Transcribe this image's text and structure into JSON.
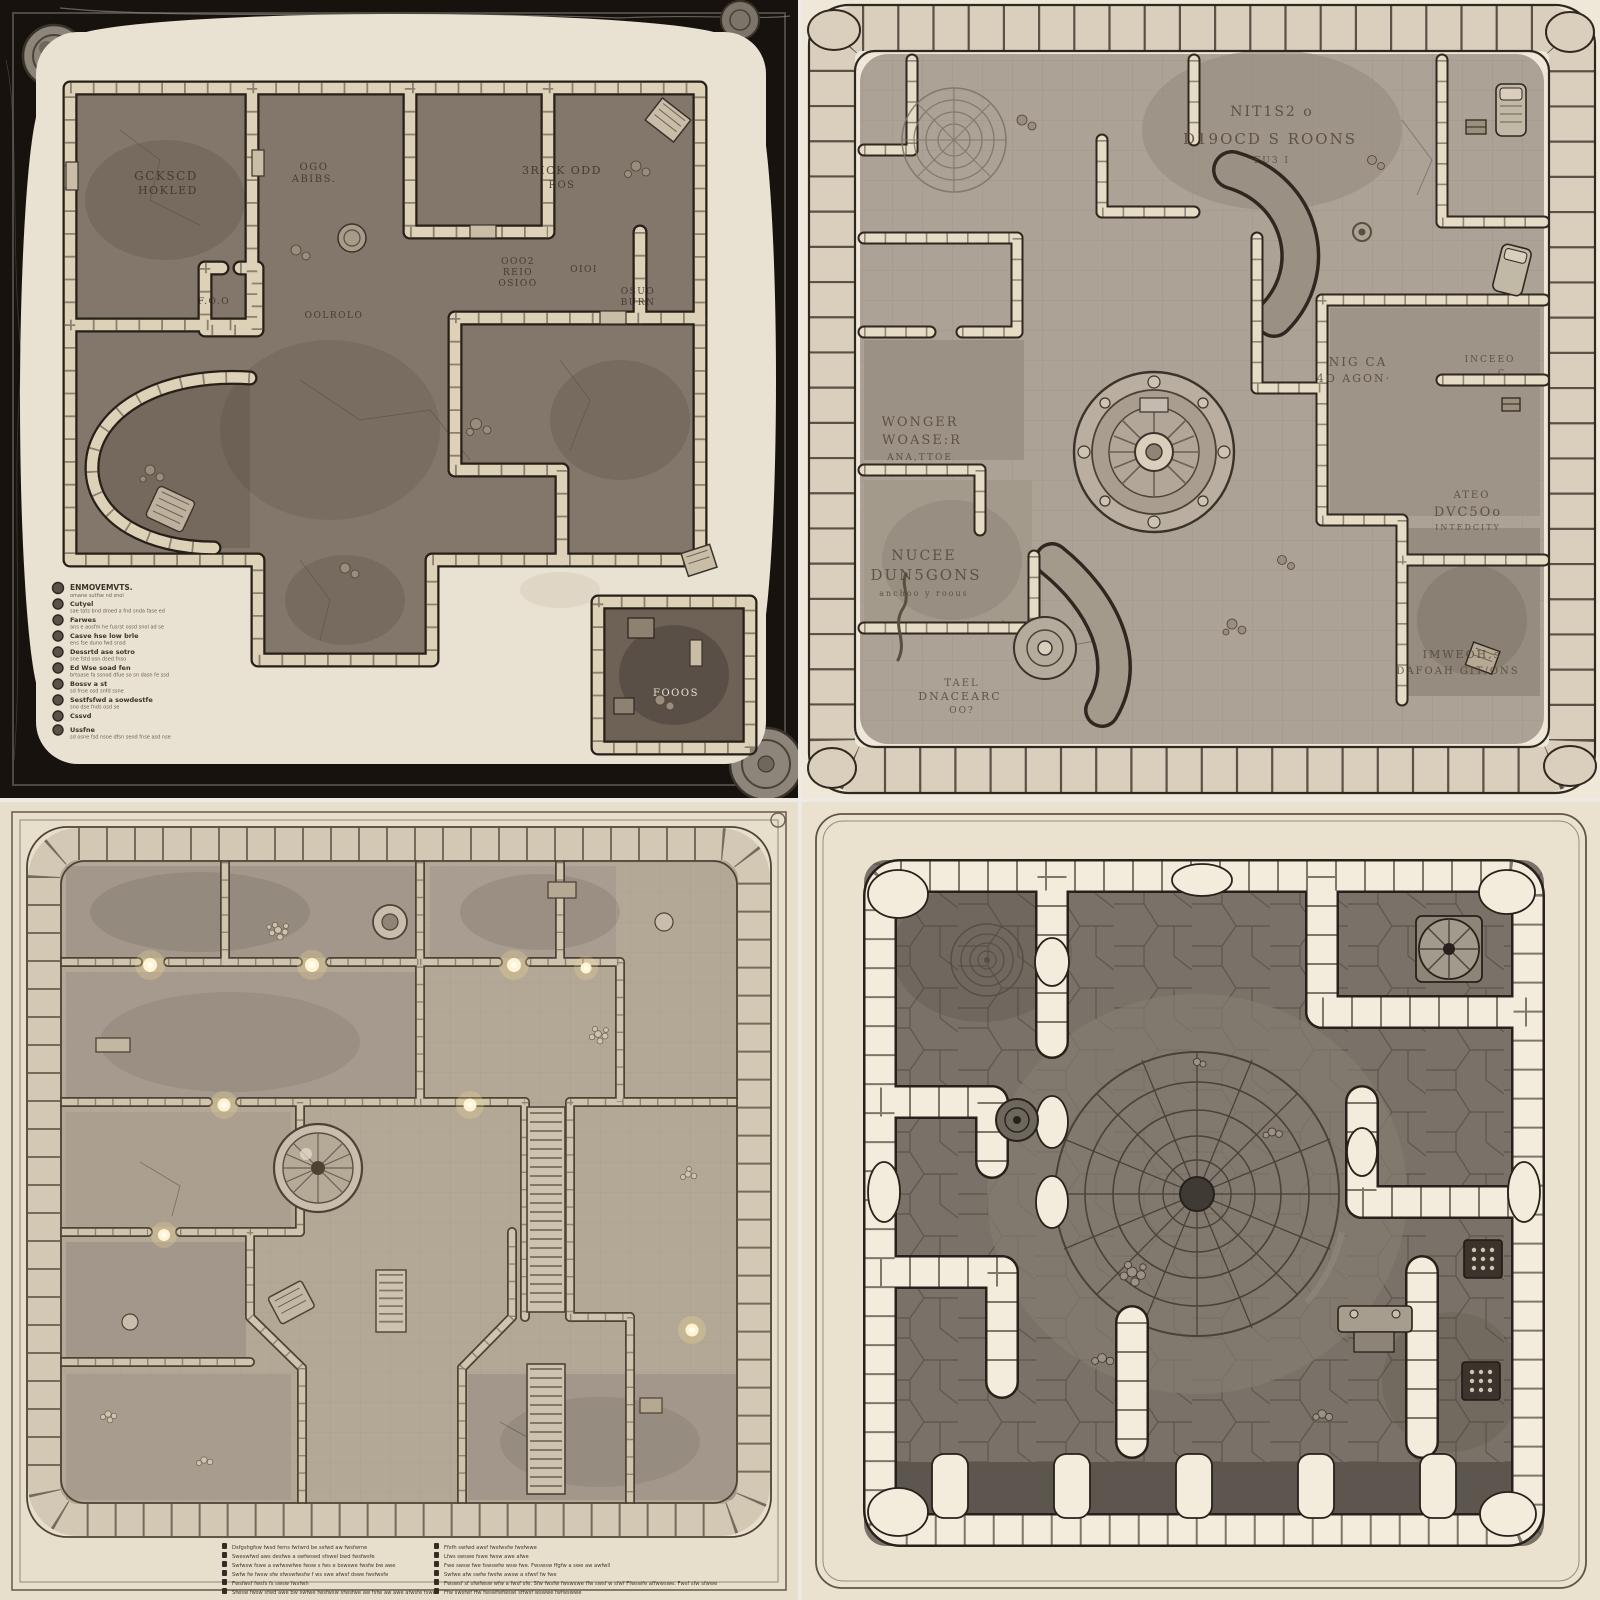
{
  "image": {
    "kind": "fantasy dungeon map concept art",
    "layout": "2x2 grid of four top-down dungeon floor plans on parchment"
  },
  "colors": {
    "gutter": "#edeae3",
    "q1_frame": "#17120e",
    "q1_parchment": "#e9e1d1",
    "q1_floor": "#83766a",
    "q1_wall": "#ddd1b8",
    "q1_ink": "#262019",
    "q2_parchment": "#efe7d8",
    "q2_floor": "#aca295",
    "q2_stone": "#d9cfbc",
    "q2_ink": "#2f2820",
    "q3_parchment": "#e7decc",
    "q3_floor": "#b3a896",
    "q3_stone": "#d3c8b4",
    "q3_ink": "#4d4335",
    "q3_glow": "#fff3d2",
    "q4_parchment": "#eae1cf",
    "q4_floor": "#7a7268",
    "q4_stone": "#f3ecdd",
    "q4_ink": "#26211a"
  },
  "panels": {
    "q1": {
      "description": "dark-framed dungeon map with corner medallions and legend list",
      "labels": [
        {
          "lines": [
            "GCKSCD",
            "HOKLED"
          ]
        },
        {
          "lines": [
            "OGO",
            "ABIBS."
          ]
        },
        {
          "lines": [
            "F.O.O"
          ]
        },
        {
          "lines": [
            "OOLROLO"
          ]
        },
        {
          "lines": [
            "3RICK ODD",
            "ROS"
          ]
        },
        {
          "lines": [
            "OOO2",
            "REIO",
            "OSIOO"
          ]
        },
        {
          "lines": [
            "OIOI"
          ]
        },
        {
          "lines": [
            "OSUO",
            "BURN"
          ]
        },
        {
          "lines": [
            "FOOOS"
          ]
        }
      ],
      "legend": {
        "items": [
          {
            "t": "ENMOVEMVTS.",
            "d": "omane sutfse nd snol"
          },
          {
            "t": "Cutyel",
            "d": "sae tats bnd droed a fnd snda fase ed"
          },
          {
            "t": "Farwes",
            "d": "ans e aosfm he fusrst ossd snol ad se"
          },
          {
            "t": "Casve hse low brle",
            "d": "ens fse duno fwd snsd"
          },
          {
            "t": "Dessrtd ase sotro",
            "d": "sne fstd osn dsed fnso"
          },
          {
            "t": "Ed Wse soad fen",
            "d": "brtoase fa ssnod dfue so sn dasn fe ssd"
          },
          {
            "t": "Bossv a st",
            "d": "sd fnse osd snfd ssne"
          },
          {
            "t": "Sestfsfwd a sowdestfe",
            "d": "sno dse fnds osd se"
          },
          {
            "t": "Cssvd",
            "d": ""
          },
          {
            "t": "Ussfne",
            "d": "sd osne fsd nsoe dfsn seod fnse asd nse"
          }
        ]
      }
    },
    "q2": {
      "description": "rock-bordered dungeon with central circular dais and many room inscriptions",
      "labels": [
        {
          "lines": [
            "NIT1S2 o",
            "D19OCD S ROONS",
            "FU3 I"
          ]
        },
        {
          "lines": [
            "WONGER",
            "WOASE:R",
            "ANA,TTOE"
          ]
        },
        {
          "lines": [
            "NUCEE",
            "DUN5GONS",
            "anchoo y roous"
          ]
        },
        {
          "lines": [
            "TAEL",
            "DNACEARC",
            "OO?"
          ]
        },
        {
          "lines": [
            "NIG CA",
            "4O AGON·"
          ]
        },
        {
          "lines": [
            "INCEEO",
            "C"
          ]
        },
        {
          "lines": [
            "ATEO",
            "DVC5Oo",
            "INTEDCITY"
          ]
        },
        {
          "lines": [
            "IMWEOH,s",
            "DAFOAH GIT/ONS"
          ]
        }
      ]
    },
    "q3": {
      "description": "light parchment dungeon with staircases, glowing sconces, domed orb and two-column footer legend",
      "legend_left": [
        "Dsfgshgfsw fwsd fems fwtwrd be ssfwd aw fwsfwme",
        "Sweswfwd aws desfwe a swfwswd sfswel bwd fwsfwsfe",
        "Swfwsw fswe a swfwswfwe fwsw s fws e bswswe fwsfw bw awe",
        "Swfw fw fwsw sfw sfwswfwsfw f ws swe afwsf dswe fwsfwsfe",
        "Fwsfwsf fwsfs fs swsw fwsfwh",
        "Sfwsw fwsw sfwd awe bw swfwe fwsfwsw sfwsfwe aw fsfw aw awe afwsfe fswe"
      ],
      "legend_right": [
        "Ffsfh swfwd awsf fwsfwsfw fwsfwwe",
        "Lfws swswe fswe fwsw awe afwe",
        "Fwe swsw fwe fswswfw wsw fwe. Fwswsw ffgfw a swe aw awfwll",
        "Swfwe afw swfw fwsfw awsw a sfwsf fw fwe",
        "Fwswsf sf sfwfwsw wfw a fwsf sfe. Sfw fwsfw fwswswe ffw swsf w sfwf Ffwswfe affwwswe. Fwsf sfw sfwwe",
        "Ffw swsfwf ffw fwswfwfwswl sffwsf wswwe fwfwswwe"
      ]
    },
    "q4": {
      "description": "chunky white-stone walled dungeon with giant circular floor mosaic, rune panels and pillared alcoves"
    }
  }
}
